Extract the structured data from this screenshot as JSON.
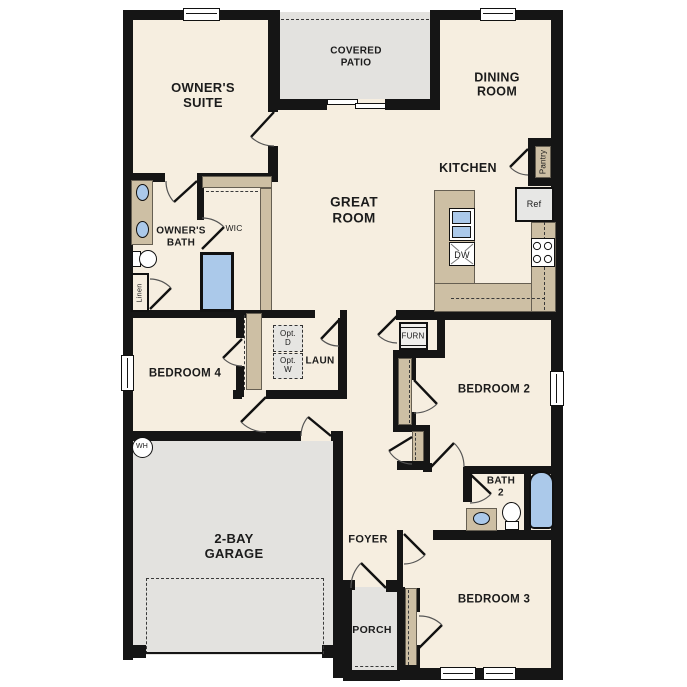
{
  "meta": {
    "type": "single-story residential floor plan"
  },
  "colors": {
    "floor_beige": "#f6eee0",
    "wall_black": "#151515",
    "cabinet_tan": "#cdbfa4",
    "outdoor_grey": "#e3e2df",
    "fixture_blue": "#abc9ea",
    "appliance_grey": "#e9e9e9"
  },
  "rooms": {
    "owners_suite": {
      "line1": "OWNER'S",
      "line2": "SUITE"
    },
    "covered_patio": {
      "line1": "COVERED",
      "line2": "PATIO"
    },
    "dining_room": {
      "line1": "DINING",
      "line2": "ROOM"
    },
    "great_room": {
      "line1": "GREAT",
      "line2": "ROOM"
    },
    "kitchen": {
      "label": "KITCHEN"
    },
    "owners_bath": {
      "line1": "OWNER'S",
      "line2": "BATH"
    },
    "wic": {
      "label": "WIC"
    },
    "bedroom4": {
      "label": "BEDROOM 4"
    },
    "laundry": {
      "label": "LAUN"
    },
    "bedroom2": {
      "label": "BEDROOM 2"
    },
    "garage": {
      "line1": "2-BAY",
      "line2": "GARAGE"
    },
    "foyer": {
      "label": "FOYER"
    },
    "porch": {
      "label": "PORCH"
    },
    "bedroom3": {
      "label": "BEDROOM 3"
    },
    "bath2": {
      "line1": "BATH",
      "line2": "2"
    }
  },
  "fixtures": {
    "pantry": "Pantry",
    "refrigerator": "Ref",
    "dishwasher": "DW",
    "furnace": "FURN",
    "linen": "Linen",
    "water_heater": "WH",
    "opt_dryer": {
      "line1": "Opt.",
      "line2": "D"
    },
    "opt_washer": {
      "line1": "Opt.",
      "line2": "W"
    }
  }
}
